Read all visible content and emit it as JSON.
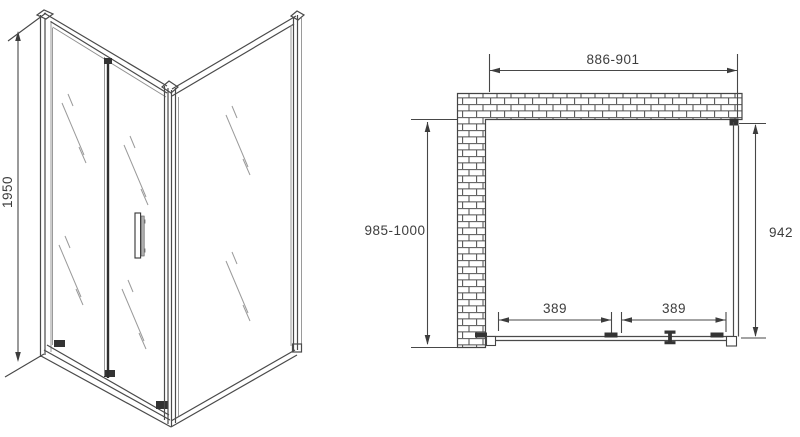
{
  "drawing": {
    "background_color": "#ffffff",
    "line_color": "#4a4a4a",
    "dark_fill_color": "#333333",
    "perspective_view": {
      "height_dim": "1950"
    },
    "plan_view": {
      "width_dim": "886-901",
      "depth_dim": "985-1000",
      "side_panel_dim": "942",
      "door_section_dims": [
        "389",
        "389"
      ]
    }
  }
}
